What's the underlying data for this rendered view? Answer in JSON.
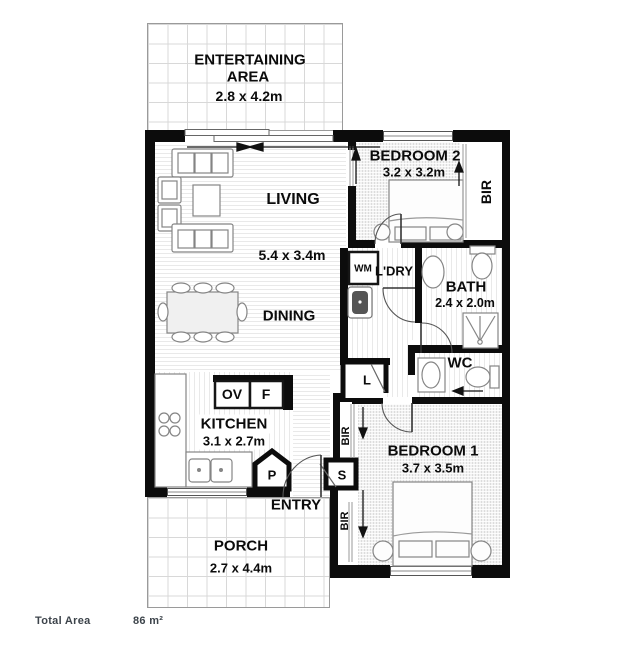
{
  "footer": {
    "total_area_label": "Total Area",
    "total_area_value": "86 m²"
  },
  "rooms": {
    "entertaining": {
      "line1": "ENTERTAINING",
      "line2": "AREA",
      "dims": "2.8 x 4.2m"
    },
    "living": {
      "name": "LIVING",
      "dims": "5.4 x 3.4m"
    },
    "dining": {
      "name": "DINING"
    },
    "bedroom2": {
      "name": "BEDROOM 2",
      "dims": "3.2 x 3.2m",
      "robe": "BIR"
    },
    "laundry": {
      "name": "L'DRY",
      "washer": "WM"
    },
    "bath": {
      "name": "BATH",
      "dims": "2.4 x 2.0m"
    },
    "wc": {
      "name": "WC"
    },
    "kitchen": {
      "name": "KITCHEN",
      "dims": "3.1 x 2.7m",
      "oven": "OV",
      "fridge": "F",
      "pantry": "P"
    },
    "linen": {
      "name": "L"
    },
    "store": {
      "name": "S"
    },
    "hall": {
      "robe_top": "BIR",
      "robe_bottom": "BIR"
    },
    "entry": {
      "name": "ENTRY"
    },
    "bedroom1": {
      "name": "BEDROOM 1",
      "dims": "3.7 x 3.5m"
    },
    "porch": {
      "name": "PORCH",
      "dims": "2.7 x 4.4m"
    }
  },
  "colors": {
    "wall": "#0c0c0c",
    "furniture_outline": "#808080",
    "tile_line": "#d8d8d8",
    "floor_line": "#e9e9e9",
    "label_text": "#0b0b0b",
    "footer_text": "#3d444b"
  }
}
